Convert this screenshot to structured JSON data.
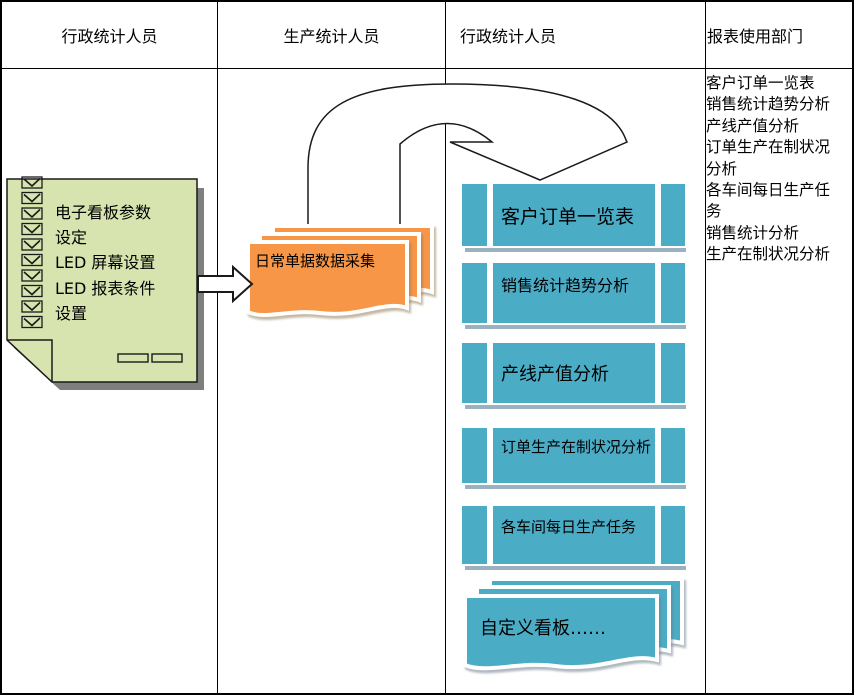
{
  "lanes": [
    {
      "label": "行政统计人员"
    },
    {
      "label": "生产统计人员"
    },
    {
      "label": "行政统计人员"
    },
    {
      "label": "报表使用部门"
    }
  ],
  "note": {
    "lines": [
      "电子看板参数",
      "设定",
      "LED 屏幕设置",
      "LED 报表条件",
      "设置"
    ]
  },
  "orange_stack": {
    "label": "日常单据数据采集"
  },
  "blue_boxes": [
    "客户订单一览表",
    "销售统计趋势分析",
    "产线产值分析",
    "订单生产在制状况分析",
    "各车间每日生产任务"
  ],
  "blue_stack": {
    "label": "自定义看板……"
  },
  "report_list": [
    "客户订单一览表",
    "销售统计趋势分析",
    "产线产值分析",
    "订单生产在制状况分析",
    "各车间每日生产任务",
    "销售统计分析",
    "生产在制状况分析"
  ],
  "colors": {
    "note_green": "#d8e4b0",
    "paper_orange": "#f79646",
    "process_blue": "#4bacc6",
    "box_shadow": "#9bb1c0",
    "note_shadow": "#7f7f7f",
    "line": "#000000"
  }
}
